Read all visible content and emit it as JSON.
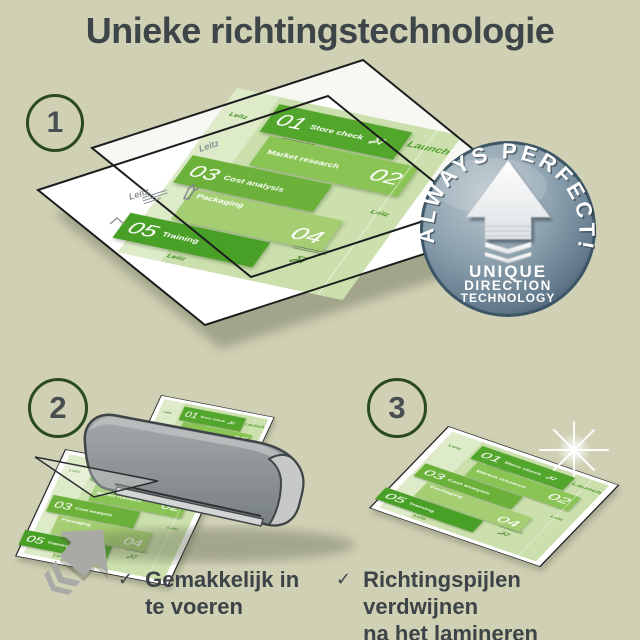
{
  "title": "Unieke richtingstechnologie",
  "steps": [
    {
      "number": "1"
    },
    {
      "number": "2"
    },
    {
      "number": "3"
    }
  ],
  "badge": {
    "arc_text": "ALWAYS PERFECT!",
    "label_line1": "UNIQUE",
    "label_line2": "DIRECTION",
    "label_line3": "TECHNOLOGY"
  },
  "document": {
    "launch_label": "Launch",
    "brand_mark": "Leitz",
    "sections": [
      {
        "num": "01",
        "label": "Store check"
      },
      {
        "num": "02",
        "label": "Market research"
      },
      {
        "num": "03",
        "label": "Cost analysis"
      },
      {
        "num": "04",
        "label": "Packaging"
      },
      {
        "num": "05",
        "label": "Training"
      }
    ]
  },
  "checklist": [
    {
      "line1": "Gemakkelijk in",
      "line2": "te voeren"
    },
    {
      "line1": "Richtingspijlen verdwijnen",
      "line2": "na het lamineren"
    }
  ],
  "colors": {
    "background": "#cfd0b4",
    "title_text": "#3e4548",
    "leitz_green": "#57a930",
    "doc_light_green": "#cbe0ad",
    "badge_steel_blue": "#7b93a3",
    "machine_gray": "#8e9394",
    "circle_green": "#2b4a21"
  }
}
